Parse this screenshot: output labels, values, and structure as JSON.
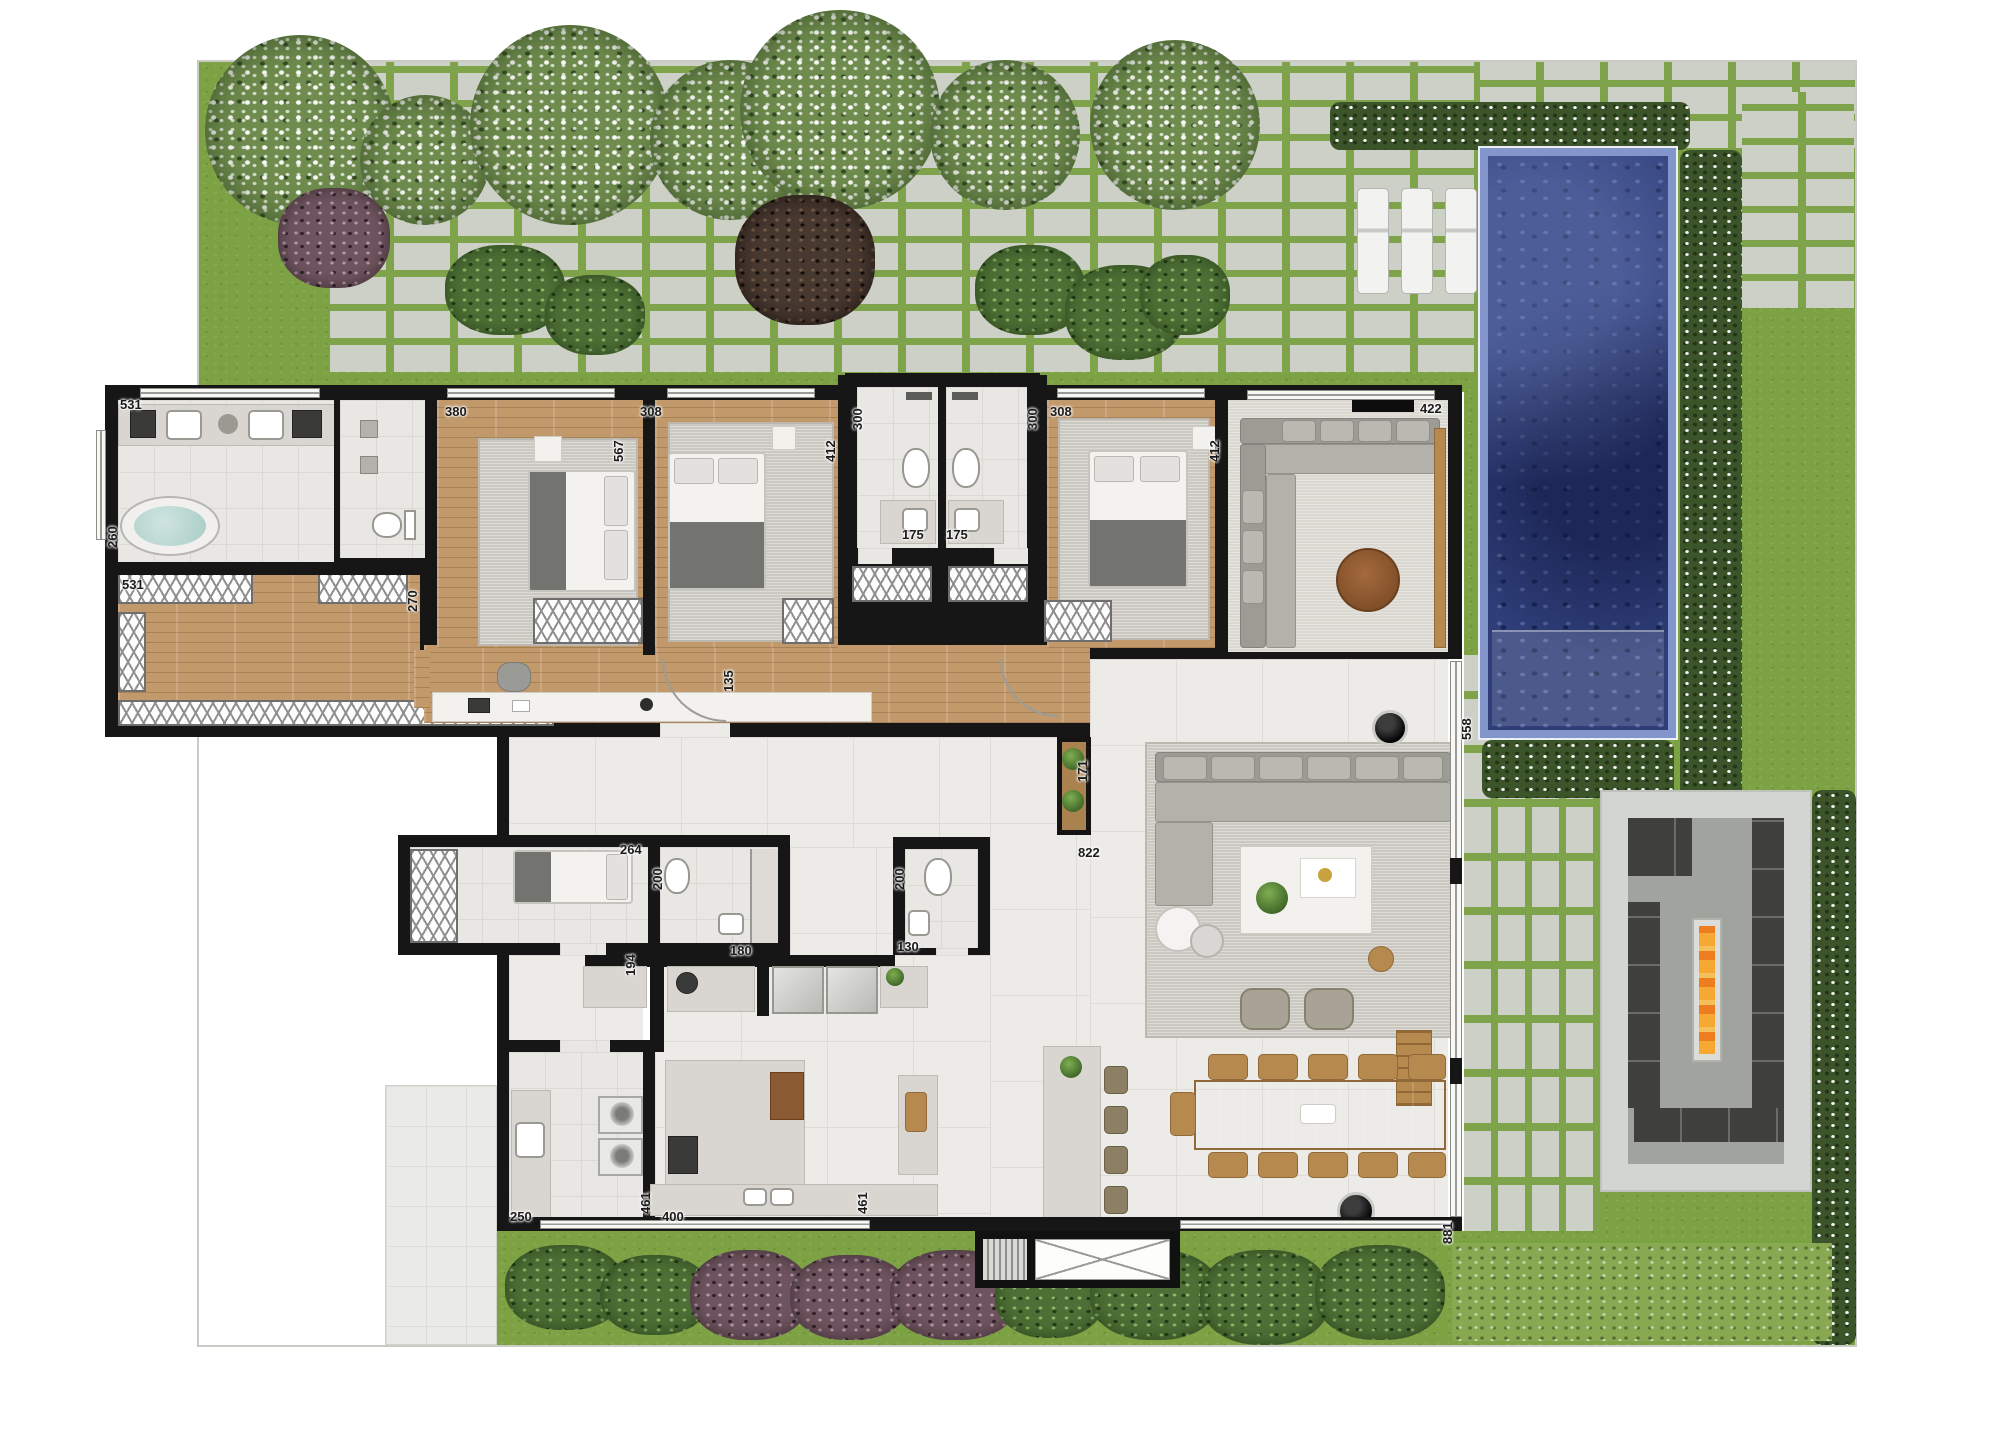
{
  "plan": {
    "canvas": {
      "width": 2000,
      "height": 1453
    },
    "palette": {
      "wall": "#161616",
      "grass": "#7ca244",
      "paver": "#ccd0c7",
      "pool_water": "#2f3e79",
      "pool_tile": "#8396cb",
      "wood_floor": "#c2996a",
      "tile_floor": "#edebe8",
      "fire": "#ee7d1f"
    },
    "dimension_labels": [
      {
        "text": "531",
        "x": 120,
        "y": 398,
        "rot": 0
      },
      {
        "text": "260",
        "x": 106,
        "y": 548,
        "rot": -90
      },
      {
        "text": "531",
        "x": 122,
        "y": 578,
        "rot": 0
      },
      {
        "text": "270",
        "x": 406,
        "y": 612,
        "rot": -90
      },
      {
        "text": "380",
        "x": 445,
        "y": 405,
        "rot": 0
      },
      {
        "text": "567",
        "x": 612,
        "y": 462,
        "rot": -90
      },
      {
        "text": "308",
        "x": 640,
        "y": 405,
        "rot": 0
      },
      {
        "text": "412",
        "x": 824,
        "y": 462,
        "rot": -90
      },
      {
        "text": "300",
        "x": 851,
        "y": 430,
        "rot": -90
      },
      {
        "text": "300",
        "x": 1026,
        "y": 430,
        "rot": -90
      },
      {
        "text": "175",
        "x": 902,
        "y": 528,
        "rot": 0
      },
      {
        "text": "175",
        "x": 946,
        "y": 528,
        "rot": 0
      },
      {
        "text": "308",
        "x": 1050,
        "y": 405,
        "rot": 0
      },
      {
        "text": "412",
        "x": 1208,
        "y": 462,
        "rot": -90
      },
      {
        "text": "422",
        "x": 1420,
        "y": 402,
        "rot": 0
      },
      {
        "text": "135",
        "x": 722,
        "y": 692,
        "rot": -90
      },
      {
        "text": "171",
        "x": 1076,
        "y": 782,
        "rot": -90
      },
      {
        "text": "822",
        "x": 1078,
        "y": 846,
        "rot": 0
      },
      {
        "text": "558",
        "x": 1460,
        "y": 740,
        "rot": -90
      },
      {
        "text": "264",
        "x": 620,
        "y": 843,
        "rot": 0
      },
      {
        "text": "200",
        "x": 651,
        "y": 890,
        "rot": -90
      },
      {
        "text": "194",
        "x": 624,
        "y": 976,
        "rot": -90
      },
      {
        "text": "180",
        "x": 730,
        "y": 944,
        "rot": 0
      },
      {
        "text": "200",
        "x": 893,
        "y": 890,
        "rot": -90
      },
      {
        "text": "130",
        "x": 897,
        "y": 940,
        "rot": 0
      },
      {
        "text": "250",
        "x": 510,
        "y": 1210,
        "rot": 0
      },
      {
        "text": "461",
        "x": 639,
        "y": 1214,
        "rot": -90
      },
      {
        "text": "400",
        "x": 662,
        "y": 1210,
        "rot": 0
      },
      {
        "text": "461",
        "x": 856,
        "y": 1214,
        "rot": -90
      },
      {
        "text": "881",
        "x": 1441,
        "y": 1244,
        "rot": -90
      }
    ]
  }
}
